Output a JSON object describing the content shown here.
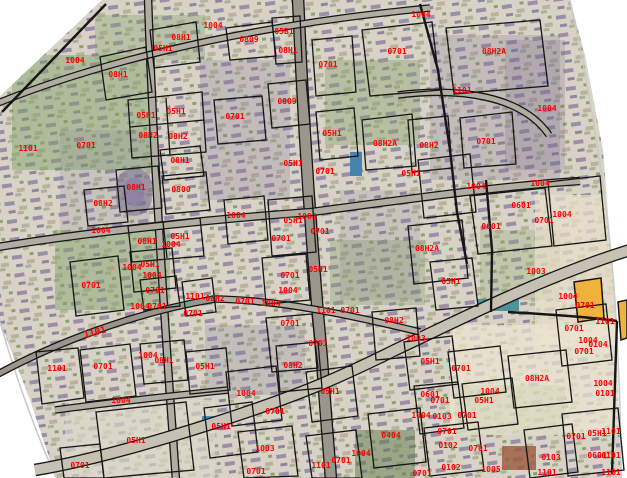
{
  "map": {
    "width": 627,
    "height": 478,
    "colors": {
      "label_red": "#fe0000",
      "line_black": "#161616",
      "road_fill": "#b2ada2",
      "road_fill_light": "#c7c1b3",
      "road_fill_dark": "#9b968c",
      "highlight_yellow": "#f0b23c",
      "photo_base": "#d8d3c6",
      "photo_edge_gray": "#c9c9c9",
      "white": "#ffffff"
    },
    "highlight_parcels": [
      "M574,282 L601,278 L604,318 L578,322 Z",
      "M618,302 L627,300 L627,338 L621,340 Z"
    ],
    "patches": [
      {
        "x": 95,
        "y": 15,
        "w": 110,
        "h": 45,
        "c": "#86a06b",
        "o": 0.35
      },
      {
        "x": 12,
        "y": 55,
        "w": 140,
        "h": 115,
        "c": "#7fa065",
        "o": 0.45
      },
      {
        "x": 55,
        "y": 230,
        "w": 115,
        "h": 80,
        "c": "#7fa065",
        "o": 0.45
      },
      {
        "x": 325,
        "y": 60,
        "w": 95,
        "h": 85,
        "c": "#86a06b",
        "o": 0.4
      },
      {
        "x": 330,
        "y": 240,
        "w": 95,
        "h": 65,
        "c": "#86a06b",
        "o": 0.35
      },
      {
        "x": 480,
        "y": 230,
        "w": 80,
        "h": 70,
        "c": "#8aa871",
        "o": 0.3
      },
      {
        "x": 455,
        "y": 385,
        "w": 110,
        "h": 50,
        "c": "#7fa065",
        "o": 0.4
      },
      {
        "x": 355,
        "y": 430,
        "w": 60,
        "h": 48,
        "c": "#5d7a4c",
        "o": 0.5
      },
      {
        "x": 200,
        "y": 60,
        "w": 90,
        "h": 140,
        "c": "#7a6d90",
        "o": 0.22
      },
      {
        "x": 430,
        "y": 35,
        "w": 130,
        "h": 145,
        "c": "#7a6d90",
        "o": 0.22
      },
      {
        "x": 505,
        "y": 40,
        "w": 60,
        "h": 130,
        "c": "#6e6186",
        "o": 0.2
      },
      {
        "x": 60,
        "y": 130,
        "w": 90,
        "h": 100,
        "c": "#7a6d90",
        "o": 0.15
      },
      {
        "x": 340,
        "y": 190,
        "w": 80,
        "h": 110,
        "c": "#7a6d90",
        "o": 0.15
      },
      {
        "x": 205,
        "y": 325,
        "w": 100,
        "h": 70,
        "c": "#7a6d90",
        "o": 0.2
      },
      {
        "x": 535,
        "y": 195,
        "w": 92,
        "h": 150,
        "c": "#eadfc9",
        "o": 0.7
      },
      {
        "x": 450,
        "y": 325,
        "w": 175,
        "h": 110,
        "c": "#eee6d2",
        "o": 0.7
      },
      {
        "x": 65,
        "y": 400,
        "w": 150,
        "h": 78,
        "c": "#dcd7ca",
        "o": 0.65
      },
      {
        "x": 116,
        "y": 168,
        "w": 36,
        "h": 48,
        "rx": 18,
        "c": "#6e6387",
        "o": 0.5
      },
      {
        "x": 124,
        "y": 178,
        "w": 20,
        "h": 28,
        "rx": 10,
        "c": "#8d80a5",
        "o": 0.8
      },
      {
        "x": 350,
        "y": 152,
        "w": 12,
        "h": 24,
        "c": "#3f7fae",
        "o": 0.95
      },
      {
        "x": 202,
        "y": 416,
        "w": 24,
        "h": 14,
        "c": "#4a86b5",
        "o": 0.95
      },
      {
        "x": 477,
        "y": 299,
        "w": 42,
        "h": 12,
        "c": "#3e8d96",
        "o": 0.9
      },
      {
        "x": 502,
        "y": 446,
        "w": 34,
        "h": 24,
        "c": "#9c5a3c",
        "o": 0.8
      }
    ],
    "white_masks": [
      "0,0 102,0 0,96",
      "0,322 30,400 56,478 0,478",
      "570,0 627,0 627,478 621,478 615,300 603,150 585,55"
    ],
    "photo_edges": [
      "M570,0 C590,90 608,200 615,300 C620,390 621,430 621,478",
      "M0,322 C15,375 35,430 56,478"
    ],
    "roads": [
      {
        "d": "M148,-2 C152,120 160,260 176,480",
        "w": 6,
        "f": "road_fill"
      },
      {
        "d": "M298,-2 C303,120 311,240 322,360 C326,420 329,450 331,480",
        "w": 10,
        "f": "road_fill_dark"
      },
      {
        "d": "M-2,103 C80,70 220,28 430,8",
        "w": 5,
        "f": "road_fill"
      },
      {
        "d": "M398,95 C460,87 522,96 549,135",
        "w": 5,
        "f": "road_fill"
      },
      {
        "d": "M-2,247 C100,230 240,217 312,212",
        "w": 6,
        "f": "road_fill"
      },
      {
        "d": "M312,212 C400,200 500,186 580,181",
        "w": 6,
        "f": "road_fill"
      },
      {
        "d": "M630,250 C540,278 455,322 395,350 C335,380 295,396 235,416 C175,436 95,460 35,470",
        "w": 10,
        "f": "road_fill_light"
      },
      {
        "d": "M55,410 C115,402 170,396 228,390",
        "w": 5,
        "f": "road_fill"
      },
      {
        "d": "M-2,374 C50,346 130,313 215,299",
        "w": 5,
        "f": "road_fill_dark"
      },
      {
        "d": "M215,299 C280,300 350,315 420,332",
        "w": 5,
        "f": "road_fill"
      }
    ],
    "parcels": [
      "M100,57 L146,47 L152,92 L106,100 Z",
      "M150,30 L196,22 L200,62 L154,68 Z",
      "M128,100 L202,92 L206,152 L132,158 Z",
      "M130,127 L204,120",
      "M166,98 L170,155",
      "M226,28 L272,22 L276,56 L230,60 Z",
      "M272,18 L300,16 L302,62 L276,64 Z",
      "M312,40 L352,36 L356,92 L316,96 Z",
      "M362,30 L432,22 L440,90 L370,96 Z",
      "M268,84 L306,80 L310,124 L272,128 Z",
      "M214,100 L262,96 L266,140 L218,144 Z",
      "M316,112 L354,108 L358,156 L320,160 Z",
      "M362,120 L412,114 L416,166 L366,170 Z",
      "M446,28 L540,20 L548,86 L454,94 Z",
      "M408,120 L448,116 L452,168 L412,172 Z",
      "M460,118 L512,112 L516,164 L464,168 Z",
      "M160,150 L200,146 L204,176 L164,180 Z",
      "M116,170 L158,166 L162,208 L120,212 Z",
      "M162,176 L206,172 L210,210 L166,214 Z",
      "M84,190 L124,186 L128,222 L88,226 Z",
      "M128,226 L200,218 L204,256 L132,262 Z",
      "M163,222 L167,258",
      "M130,252 L172,248 L176,288 L134,292 Z",
      "M70,262 L118,256 L124,310 L76,316 Z",
      "M140,280 L176,276 L180,306 L144,310 Z",
      "M182,282 L212,278 L216,312 L186,316 Z",
      "M268,200 L312,196 L316,252 L272,256 Z",
      "M262,258 L306,254 L310,300 L266,304 Z",
      "M224,200 L264,196 L268,240 L228,244 Z",
      "M418,160 L470,154 L476,212 L424,218 Z",
      "M470,196 L545,188 L552,246 L478,254 Z",
      "M408,226 L462,220 L468,278 L414,284 Z",
      "M430,262 L472,258 L478,306 L436,310 Z",
      "M266,318 L312,314 L318,368 L272,372 Z",
      "M372,312 L416,308 L420,356 L376,360 Z",
      "M276,346 L318,342 L322,388 L280,392 Z",
      "M186,352 L226,348 L230,390 L190,394 Z",
      "M140,344 L184,340 L188,380 L144,384 Z",
      "M80,350 L130,344 L136,396 L86,402 Z",
      "M36,352 L78,348 L84,398 L42,404 Z",
      "M96,412 L186,402 L194,470 L104,478 Z",
      "M60,448 L100,444 L104,478 L64,478 Z",
      "M204,408 L252,402 L258,452 L210,458 Z",
      "M226,372 L276,366 L282,420 L232,426 Z",
      "M306,372 L352,366 L358,416 L312,422 Z",
      "M238,432 L292,426 L298,476 L244,478 Z",
      "M306,436 L356,430 L362,478 L312,478 Z",
      "M368,414 L420,408 L426,462 L374,468 Z",
      "M404,342 L452,336 L458,384 L410,390 Z",
      "M448,352 L500,346 L506,392 L454,398 Z",
      "M508,356 L566,350 L572,402 L514,408 Z",
      "M462,384 L512,378 L518,424 L468,430 Z",
      "M414,386 L458,382 L464,428 L420,434 Z",
      "M424,428 L478,422 L484,470 L430,476 Z",
      "M524,430 L572,424 L578,472 L530,478 Z",
      "M556,310 L606,304 L612,360 L562,366 Z",
      "M562,414 L618,408 L624,470 L568,476 Z",
      "M548,182 L600,176 L606,240 L554,246 Z"
    ],
    "boundaries": [
      "M2,112 L106,4",
      "M420,4 L438,70 L450,150 L457,212 L467,264",
      "M486,180 L492,250 L491,312",
      "M508,312 C560,315 598,318 617,321",
      "M617,321 L612,474"
    ],
    "labels": [
      {
        "t": "1101",
        "x": 28,
        "y": 149
      },
      {
        "t": "1004",
        "x": 75,
        "y": 61
      },
      {
        "t": "08H1",
        "x": 118,
        "y": 75
      },
      {
        "t": "05H1",
        "x": 163,
        "y": 49
      },
      {
        "t": "08H1",
        "x": 181,
        "y": 38
      },
      {
        "t": "05H1",
        "x": 146,
        "y": 116
      },
      {
        "t": "05H1",
        "x": 176,
        "y": 112
      },
      {
        "t": "08H2",
        "x": 148,
        "y": 136
      },
      {
        "t": "08H2",
        "x": 178,
        "y": 137
      },
      {
        "t": "0701",
        "x": 86,
        "y": 146
      },
      {
        "t": "1004",
        "x": 213,
        "y": 26
      },
      {
        "t": "0809",
        "x": 249,
        "y": 40
      },
      {
        "t": "05B1",
        "x": 284,
        "y": 32
      },
      {
        "t": "08H1",
        "x": 288,
        "y": 51
      },
      {
        "t": "0701",
        "x": 328,
        "y": 65
      },
      {
        "t": "0701",
        "x": 397,
        "y": 52
      },
      {
        "t": "0809",
        "x": 287,
        "y": 102
      },
      {
        "t": "0701",
        "x": 235,
        "y": 117
      },
      {
        "t": "05H1",
        "x": 332,
        "y": 134
      },
      {
        "t": "08H2A",
        "x": 385,
        "y": 144
      },
      {
        "t": "1004",
        "x": 421,
        "y": 15
      },
      {
        "t": "08H2A",
        "x": 494,
        "y": 52
      },
      {
        "t": "1101",
        "x": 462,
        "y": 91
      },
      {
        "t": "1004",
        "x": 547,
        "y": 109
      },
      {
        "t": "08H2",
        "x": 429,
        "y": 146
      },
      {
        "t": "0701",
        "x": 486,
        "y": 142
      },
      {
        "t": "08H1",
        "x": 180,
        "y": 161
      },
      {
        "t": "08H1",
        "x": 136,
        "y": 188
      },
      {
        "t": "0800",
        "x": 181,
        "y": 190
      },
      {
        "t": "08H2",
        "x": 103,
        "y": 204
      },
      {
        "t": "1004",
        "x": 101,
        "y": 231
      },
      {
        "t": "08H1",
        "x": 147,
        "y": 242
      },
      {
        "t": "05H1",
        "x": 180,
        "y": 237
      },
      {
        "t": "1004",
        "x": 171,
        "y": 245
      },
      {
        "t": "1004",
        "x": 132,
        "y": 268
      },
      {
        "t": "05H1",
        "x": 150,
        "y": 265
      },
      {
        "t": "1004",
        "x": 152,
        "y": 276
      },
      {
        "t": "0701",
        "x": 91,
        "y": 286
      },
      {
        "t": "0701",
        "x": 155,
        "y": 291
      },
      {
        "t": "1101",
        "x": 195,
        "y": 297
      },
      {
        "t": "0701",
        "x": 193,
        "y": 314
      },
      {
        "t": "05H1",
        "x": 293,
        "y": 164
      },
      {
        "t": "0701",
        "x": 325,
        "y": 172
      },
      {
        "t": "05H1",
        "x": 411,
        "y": 174
      },
      {
        "t": "1004",
        "x": 236,
        "y": 216
      },
      {
        "t": "05H1",
        "x": 293,
        "y": 221
      },
      {
        "t": "1003",
        "x": 307,
        "y": 217
      },
      {
        "t": "0701",
        "x": 320,
        "y": 232
      },
      {
        "t": "0701",
        "x": 281,
        "y": 239
      },
      {
        "t": "0701",
        "x": 290,
        "y": 276
      },
      {
        "t": "05H1",
        "x": 318,
        "y": 270
      },
      {
        "t": "1004",
        "x": 288,
        "y": 291
      },
      {
        "t": "08H2",
        "x": 215,
        "y": 299
      },
      {
        "t": "0701",
        "x": 245,
        "y": 302
      },
      {
        "t": "1004",
        "x": 271,
        "y": 304
      },
      {
        "t": "1101",
        "x": 326,
        "y": 311
      },
      {
        "t": "0701",
        "x": 350,
        "y": 311
      },
      {
        "t": "1004",
        "x": 476,
        "y": 187
      },
      {
        "t": "1004",
        "x": 540,
        "y": 184
      },
      {
        "t": "0601",
        "x": 521,
        "y": 206
      },
      {
        "t": "1004",
        "x": 562,
        "y": 215
      },
      {
        "t": "0701",
        "x": 544,
        "y": 221
      },
      {
        "t": "0601",
        "x": 491,
        "y": 227
      },
      {
        "t": "08H2A",
        "x": 427,
        "y": 249
      },
      {
        "t": "05H1",
        "x": 451,
        "y": 282
      },
      {
        "t": "1003",
        "x": 536,
        "y": 272
      },
      {
        "t": "1004",
        "x": 568,
        "y": 297
      },
      {
        "t": "0701",
        "x": 585,
        "y": 306
      },
      {
        "t": "1004",
        "x": 140,
        "y": 307
      },
      {
        "t": "0701",
        "x": 157,
        "y": 307
      },
      {
        "t": "1101",
        "x": 95,
        "y": 333,
        "b": 1,
        "r": -14
      },
      {
        "t": "1101",
        "x": 57,
        "y": 369
      },
      {
        "t": "0701",
        "x": 103,
        "y": 367
      },
      {
        "t": "1004",
        "x": 148,
        "y": 356
      },
      {
        "t": "08H1",
        "x": 164,
        "y": 361
      },
      {
        "t": "05H1",
        "x": 205,
        "y": 367
      },
      {
        "t": "1004",
        "x": 121,
        "y": 401
      },
      {
        "t": "05H1",
        "x": 136,
        "y": 441
      },
      {
        "t": "0701",
        "x": 80,
        "y": 466
      },
      {
        "t": "0701",
        "x": 290,
        "y": 324
      },
      {
        "t": "08H2",
        "x": 394,
        "y": 321
      },
      {
        "t": "0701",
        "x": 318,
        "y": 344
      },
      {
        "t": "08H2",
        "x": 293,
        "y": 366
      },
      {
        "t": "1004",
        "x": 246,
        "y": 394
      },
      {
        "t": "0701",
        "x": 275,
        "y": 412
      },
      {
        "t": "05H1",
        "x": 221,
        "y": 427
      },
      {
        "t": "05H1",
        "x": 330,
        "y": 392
      },
      {
        "t": "1003",
        "x": 265,
        "y": 449
      },
      {
        "t": "1004",
        "x": 361,
        "y": 454
      },
      {
        "t": "0701",
        "x": 341,
        "y": 461
      },
      {
        "t": "1101",
        "x": 321,
        "y": 466
      },
      {
        "t": "0701",
        "x": 256,
        "y": 472
      },
      {
        "t": "0404",
        "x": 391,
        "y": 436
      },
      {
        "t": "1003",
        "x": 416,
        "y": 339
      },
      {
        "t": "0701",
        "x": 574,
        "y": 329
      },
      {
        "t": "1101",
        "x": 605,
        "y": 322
      },
      {
        "t": "1004",
        "x": 588,
        "y": 341
      },
      {
        "t": "0104",
        "x": 598,
        "y": 345
      },
      {
        "t": "0701",
        "x": 584,
        "y": 352
      },
      {
        "t": "05H1",
        "x": 430,
        "y": 362
      },
      {
        "t": "0701",
        "x": 461,
        "y": 369
      },
      {
        "t": "08H2A",
        "x": 537,
        "y": 379
      },
      {
        "t": "1004",
        "x": 490,
        "y": 392
      },
      {
        "t": "05H1",
        "x": 484,
        "y": 401
      },
      {
        "t": "0601",
        "x": 430,
        "y": 395
      },
      {
        "t": "0701",
        "x": 440,
        "y": 401
      },
      {
        "t": "1004",
        "x": 421,
        "y": 416
      },
      {
        "t": "0103",
        "x": 442,
        "y": 417
      },
      {
        "t": "0701",
        "x": 467,
        "y": 416
      },
      {
        "t": "0701",
        "x": 447,
        "y": 432
      },
      {
        "t": "0102",
        "x": 448,
        "y": 446
      },
      {
        "t": "0701",
        "x": 478,
        "y": 449
      },
      {
        "t": "0102",
        "x": 451,
        "y": 468
      },
      {
        "t": "1005",
        "x": 491,
        "y": 470
      },
      {
        "t": "0103",
        "x": 551,
        "y": 458
      },
      {
        "t": "1101",
        "x": 547,
        "y": 473
      },
      {
        "t": "0701",
        "x": 422,
        "y": 474
      },
      {
        "t": "1004",
        "x": 603,
        "y": 384
      },
      {
        "t": "0101",
        "x": 605,
        "y": 394
      },
      {
        "t": "0701",
        "x": 576,
        "y": 437
      },
      {
        "t": "05H1",
        "x": 597,
        "y": 434
      },
      {
        "t": "1101",
        "x": 611,
        "y": 432
      },
      {
        "t": "0601",
        "x": 597,
        "y": 456
      },
      {
        "t": "0101",
        "x": 611,
        "y": 456
      },
      {
        "t": "1101",
        "x": 611,
        "y": 473
      }
    ]
  }
}
